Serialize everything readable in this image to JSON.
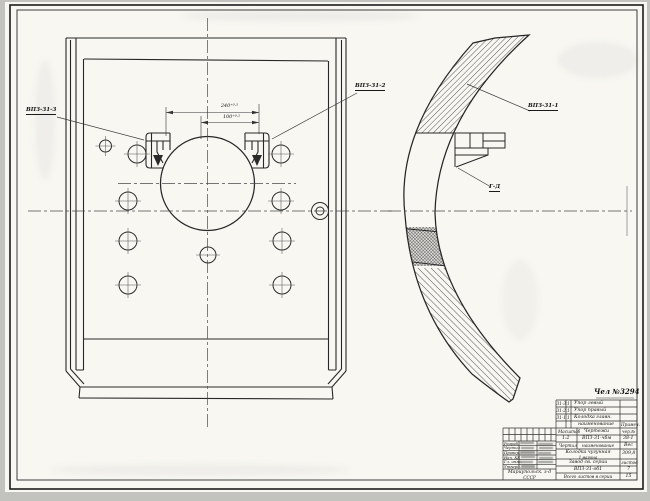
{
  "views": {
    "front_view_callout_left": "ВПЗ-31-3",
    "front_view_callout_right": "ВПЗ-31-2",
    "side_view_callout": "ВПЗ-31-1",
    "section_mark": "Г-Д",
    "dim_outer": "240⁺⁰·⁵",
    "dim_inner": "100⁺⁰·²"
  },
  "title_block": {
    "note": "Чел №3294",
    "parts": [
      {
        "num": "31-3",
        "qty": "1",
        "name": "Упор левый"
      },
      {
        "num": "31-2",
        "qty": "1",
        "name": "Упор правый"
      },
      {
        "num": "31-1",
        "qty": "1",
        "name": "Колодка главн."
      }
    ],
    "header": {
      "name": "наименование",
      "note": "Примеч."
    },
    "rows": [
      {
        "a": "Масштаб",
        "b": "Чертежи",
        "c": "чер.№"
      },
      {
        "a": "1:2",
        "b": "ВПЗ-31-чбм",
        "c": "38-1"
      },
      {
        "a": "Чертил",
        "b": "наименование",
        "c": "Вес"
      },
      {
        "a": "",
        "b": "Колодка чугунная",
        "b2": "1 вагона",
        "c": "309,8"
      },
      {
        "a": "",
        "b": "Завод св. серии",
        "c": "листов"
      },
      {
        "a": "",
        "b": "ВПЗ-31-об1",
        "c": "7"
      },
      {
        "a": "",
        "b": "Всего листов в серии",
        "c": "15"
      }
    ],
    "stamp": {
      "rows": [
        "Разраб.",
        "Чертил",
        "Провер.",
        "Нач. КБ",
        "Гл. инж.",
        "Утверд."
      ],
      "org1": "Мариупольск. з-д",
      "org2": "СССР"
    }
  }
}
